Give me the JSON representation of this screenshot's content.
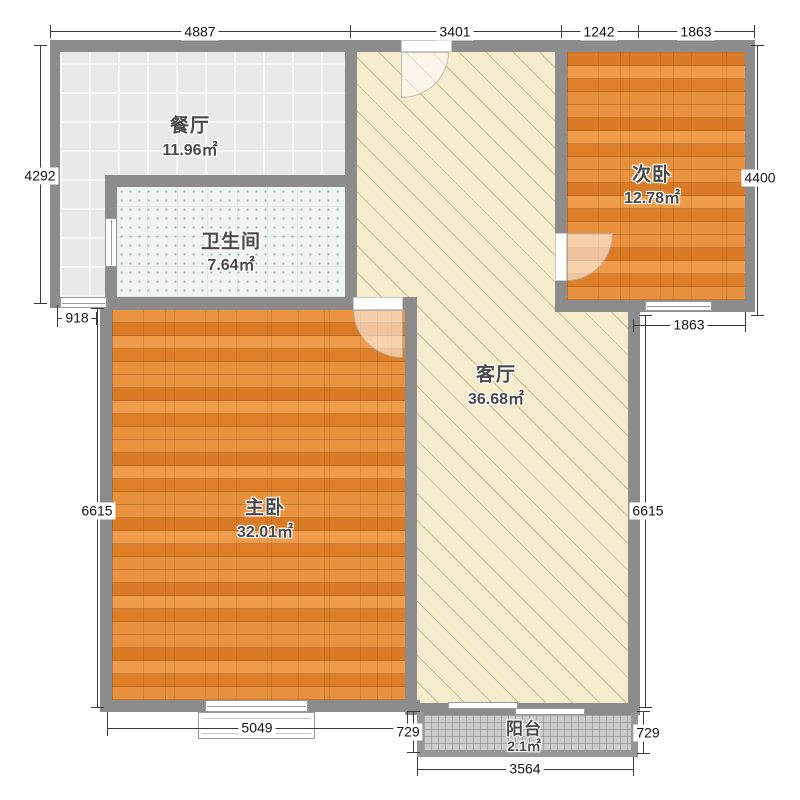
{
  "rooms": [
    {
      "id": "dining",
      "name": "餐厅",
      "area": "11.96㎡"
    },
    {
      "id": "bathroom",
      "name": "卫生间",
      "area": "7.64㎡"
    },
    {
      "id": "secondary-bedroom",
      "name": "次卧",
      "area": "12.78㎡"
    },
    {
      "id": "living-room",
      "name": "客厅",
      "area": "36.68㎡"
    },
    {
      "id": "master-bedroom",
      "name": "主卧",
      "area": "32.01㎡"
    },
    {
      "id": "balcony",
      "name": "阳台",
      "area": "2.1㎡"
    }
  ],
  "dimensions": {
    "top": [
      "4887",
      "3401",
      "1242",
      "1863"
    ],
    "left": {
      "outer": "4292",
      "inner": "6615",
      "offset": "918"
    },
    "right": {
      "outer": "4400",
      "inner": "6615",
      "bedroom_bottom": "1863"
    },
    "bottom": {
      "master": "5049",
      "balcony_left": "729",
      "balcony_right": "729",
      "balcony": "3564"
    }
  },
  "colors": {
    "wall": "#8c8c8c",
    "living_floor": "#f5ecce",
    "dining_floor": "#e9e9ec",
    "bath_floor": "#f0f5f4",
    "wood_floor": "#e2852f",
    "balcony_floor": "#cbcbcb",
    "dimension_line": "#3a3a3a"
  }
}
